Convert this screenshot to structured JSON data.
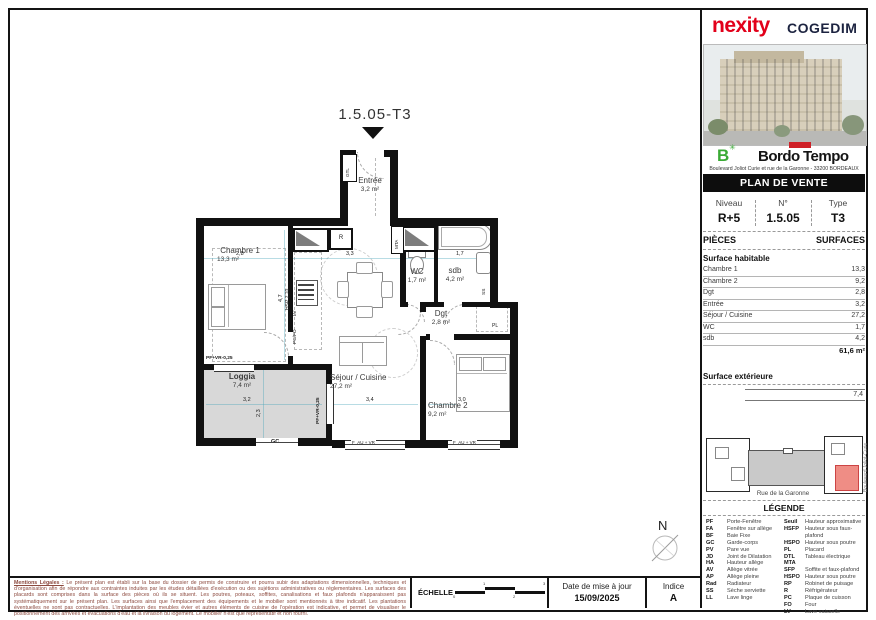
{
  "brand": {
    "left": "nexity",
    "right": "COGEDIM"
  },
  "project": {
    "logo_letter": "B",
    "logo_star": "✳",
    "name_part1": "Bordo",
    "name_part2": "Tempo",
    "address": "Boulevard Joliot Curie et rue de la Garonne - 33200 BORDEAUX",
    "banner": "PLAN DE VENTE COMMERCIAL"
  },
  "info": {
    "niveau_label": "Niveau",
    "niveau_value": "R+5",
    "num_label": "N°",
    "num_value": "1.5.05",
    "type_label": "Type",
    "type_value": "T3"
  },
  "surfaces": {
    "pieces_label": "PIÈCES",
    "surfaces_label": "SURFACES",
    "habitable_title": "Surface habitable",
    "rows": [
      {
        "label": "Chambre 1",
        "value": "13,3"
      },
      {
        "label": "Chambre 2",
        "value": "9,2"
      },
      {
        "label": "Dgt",
        "value": "2,8"
      },
      {
        "label": "Entrée",
        "value": "3,2"
      },
      {
        "label": "Séjour / Cuisine",
        "value": "27,2"
      },
      {
        "label": "WC",
        "value": "1,7"
      },
      {
        "label": "sdb",
        "value": "4,2"
      }
    ],
    "total": "61,6 m²",
    "exterieure_title": "Surface extérieure",
    "exterieure_value": "7,4"
  },
  "site_map": {
    "street": "Rue de la Garonne",
    "street_side": "Boulevard Joliot-Curie"
  },
  "legend": {
    "title": "LÉGENDE",
    "left": [
      {
        "abbr": "PF",
        "label": "Porte-Fenêtre"
      },
      {
        "abbr": "FA",
        "label": "Fenêtre sur allège"
      },
      {
        "abbr": "BF",
        "label": "Baie Fixe"
      },
      {
        "abbr": "GC",
        "label": "Garde-corps"
      },
      {
        "abbr": "PV",
        "label": "Pare vue"
      },
      {
        "abbr": "JD",
        "label": "Joint de Dilatation"
      },
      {
        "abbr": "HA",
        "label": "Hauteur allège"
      },
      {
        "abbr": "AV",
        "label": "Allège vitrée"
      },
      {
        "abbr": "AP",
        "label": "Allège pleine"
      },
      {
        "abbr": "Rad",
        "label": "Radiateur"
      },
      {
        "abbr": "SS",
        "label": "Sèche serviette"
      },
      {
        "abbr": "LL",
        "label": "Lave linge"
      }
    ],
    "right": [
      {
        "abbr": "Seuil",
        "label": "Hauteur approximative"
      },
      {
        "abbr": "HSFP",
        "label": "Hauteur sous faux-plafond"
      },
      {
        "abbr": "HSPO",
        "label": "Hauteur sous poutre"
      },
      {
        "abbr": "PL",
        "label": "Placard"
      },
      {
        "abbr": "DTL",
        "label": "Tableau électrique"
      },
      {
        "abbr": "MTA",
        "label": ""
      },
      {
        "abbr": "SFP",
        "label": "Soffite et faux-plafond"
      },
      {
        "abbr": "HSPO",
        "label": "Hauteur sous poutre"
      },
      {
        "abbr": "RP",
        "label": "Robinet de puisage"
      },
      {
        "abbr": "R",
        "label": "Réfrigérateur"
      },
      {
        "abbr": "PC",
        "label": "Plaque de cuisson"
      },
      {
        "abbr": "FO",
        "label": "Four"
      },
      {
        "abbr": "LV",
        "label": "Lave vaisselle"
      }
    ]
  },
  "plan": {
    "title": "1.5.05-T3",
    "north": "N",
    "rooms": [
      {
        "name": "Entrée",
        "area": "3,2 m²"
      },
      {
        "name": "Chambre 1",
        "area": "13,3 m²"
      },
      {
        "name": "WC",
        "area": "1,7 m²"
      },
      {
        "name": "sdb",
        "area": "4,2 m²"
      },
      {
        "name": "Dgt",
        "area": "2,8 m²"
      },
      {
        "name": "Séjour / Cuisine",
        "area": "27,2 m²"
      },
      {
        "name": "Chambre 2",
        "area": "9,2 m²"
      },
      {
        "name": "Loggia",
        "area": "7,4 m²"
      }
    ],
    "labels": {
      "gtl": "GTL",
      "mta": "MTA",
      "r": "R",
      "lv": "LV",
      "pcfo": "PC/FO",
      "pl": "PL",
      "gc": "GC",
      "ss": "SS",
      "hsp": "HSP 2,70",
      "pf_vr": "PF+VR-0,25",
      "pf_vr2": "PF+VR-0,25",
      "f_au1": "F_AU + VR",
      "f_au2": "F_AU + VR"
    },
    "dims": {
      "d28": "2,8",
      "d33": "3,3",
      "d17": "1,7",
      "d47": "4,7",
      "d32": "3,2",
      "d23": "2,3",
      "d34": "3,4",
      "d30": "3,0"
    }
  },
  "footer": {
    "mentions_title": "Mentions Légales :",
    "mentions_text": "Le présent plan est établi sur la base du dossier de permis de construire et pourra subir des adaptations dimensionnelles, techniques et d'organisation afin de répondre aux contraintes induites par les études détaillées d'exécution ou des sujétions administratives ou réglementaires. Les surfaces des placards sont comprises dans la surface des pièces où ils se situent. Les poutres, poteaux, soffites, canalisations et faux plafonds n'apparaissent pas systématiquement sur le présent plan. Les surfaces ainsi que l'emplacement des équipements et le mobilier sont mentionnés à titre indicatif. Les plantations éventuelles ne sont pas contractuelles. L'implantation des meubles évier et autres éléments de cuisine de l'opération est indicative, et permet de visualiser le positionnement des arrivées et évacuations d'eau et la livraison du logement. Le mobilier n'est que représentatif et non fourni.",
    "echelle_label": "ÉCHELLE",
    "scale_ticks": [
      "0",
      "1",
      "2",
      "3"
    ],
    "date_label": "Date de mise à jour",
    "date_value": "15/09/2025",
    "indice_label": "Indice",
    "indice_value": "A"
  }
}
